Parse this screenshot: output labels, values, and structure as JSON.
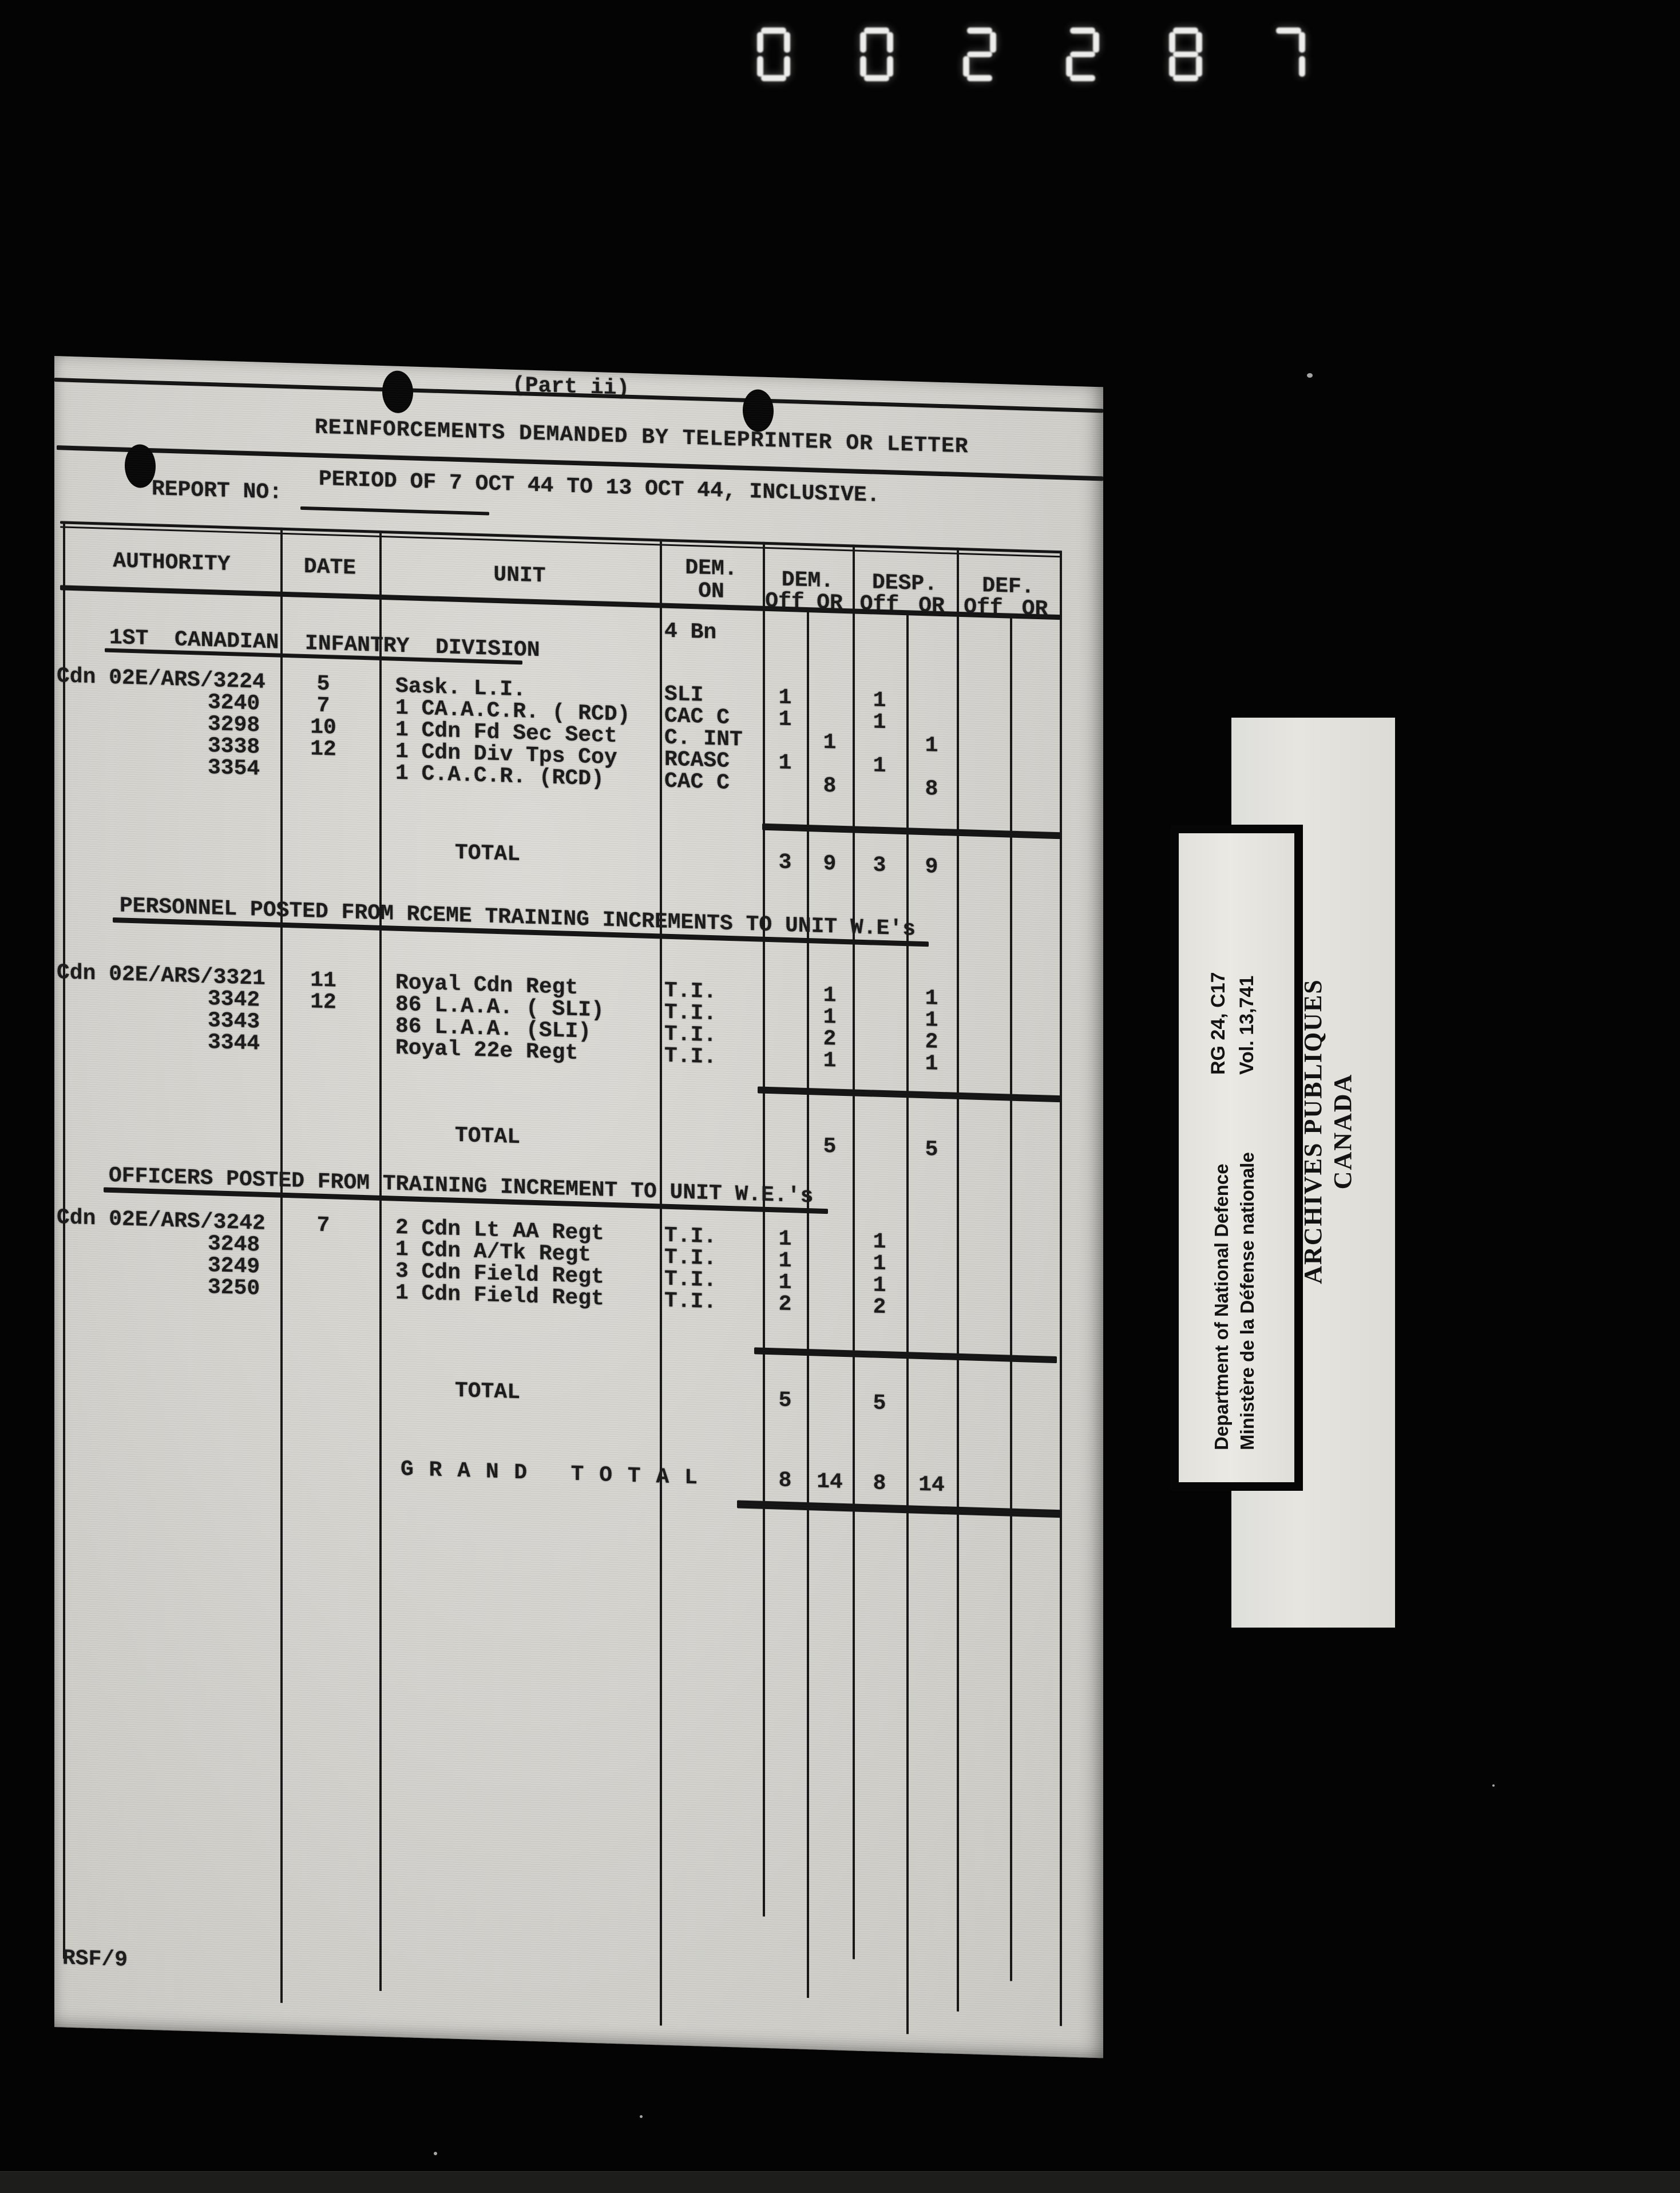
{
  "counter": {
    "digits": "002287"
  },
  "page": {
    "part_label": "(Part ii)",
    "title": "REINFORCEMENTS DEMANDED BY TELEPRINTER OR LETTER",
    "report_no_label": "REPORT NO:",
    "period_line": "PERIOD OF 7 OCT 44 TO 13 OCT 44, INCLUSIVE.",
    "footer_code": "RSF/9"
  },
  "table": {
    "columns": {
      "authority": "AUTHORITY",
      "date": "DATE",
      "unit": "UNIT",
      "dem_on_1": "DEM.",
      "dem_on_2": "ON",
      "dem": "DEM.",
      "desp": "DESP.",
      "def": "DEF.",
      "off": "Off",
      "or": "OR"
    },
    "dem_on_value": "4 Bn",
    "sections": [
      {
        "heading": "1ST  CANADIAN  INFANTRY  DIVISION",
        "rows": [
          {
            "authority": "Cdn 02E/ARS/3224",
            "date": "5",
            "unit": "Sask. L.I.",
            "dem_on": "SLI",
            "dem_off": "1",
            "dem_or": "",
            "desp_off": "1",
            "desp_or": "",
            "def_off": "",
            "def_or": ""
          },
          {
            "authority": "3240",
            "date": "7",
            "unit": "1 CA.A.C.R. ( RCD)",
            "dem_on": "CAC C",
            "dem_off": "1",
            "dem_or": "",
            "desp_off": "1",
            "desp_or": "",
            "def_off": "",
            "def_or": ""
          },
          {
            "authority": "3298",
            "date": "10",
            "unit": "1 Cdn Fd Sec Sect",
            "dem_on": "C. INT",
            "dem_off": "",
            "dem_or": "1",
            "desp_off": "",
            "desp_or": "1",
            "def_off": "",
            "def_or": ""
          },
          {
            "authority": "3338",
            "date": "12",
            "unit": "1 Cdn Div Tps Coy",
            "dem_on": "RCASC",
            "dem_off": "1",
            "dem_or": "",
            "desp_off": "1",
            "desp_or": "",
            "def_off": "",
            "def_or": ""
          },
          {
            "authority": "3354",
            "date": "",
            "unit": "1 C.A.C.R. (RCD)",
            "dem_on": "CAC C",
            "dem_off": "",
            "dem_or": "8",
            "desp_off": "",
            "desp_or": "8",
            "def_off": "",
            "def_or": ""
          }
        ],
        "total": {
          "label": "TOTAL",
          "dem_off": "3",
          "dem_or": "9",
          "desp_off": "3",
          "desp_or": "9"
        }
      },
      {
        "heading": "PERSONNEL POSTED FROM RCEME TRAINING INCREMENTS TO UNIT W.E's",
        "rows": [
          {
            "authority": "Cdn 02E/ARS/3321",
            "date": "11",
            "unit": "Royal Cdn Regt",
            "dem_on": "T.I.",
            "dem_off": "",
            "dem_or": "1",
            "desp_off": "",
            "desp_or": "1",
            "def_off": "",
            "def_or": ""
          },
          {
            "authority": "3342",
            "date": "12",
            "unit": "86 L.A.A. ( SLI)",
            "dem_on": "T.I.",
            "dem_off": "",
            "dem_or": "1",
            "desp_off": "",
            "desp_or": "1",
            "def_off": "",
            "def_or": ""
          },
          {
            "authority": "3343",
            "date": "",
            "unit": "86 L.A.A. (SLI)",
            "dem_on": "T.I.",
            "dem_off": "",
            "dem_or": "2",
            "desp_off": "",
            "desp_or": "2",
            "def_off": "",
            "def_or": ""
          },
          {
            "authority": "3344",
            "date": "",
            "unit": "Royal 22e Regt",
            "dem_on": "T.I.",
            "dem_off": "",
            "dem_or": "1",
            "desp_off": "",
            "desp_or": "1",
            "def_off": "",
            "def_or": ""
          }
        ],
        "total": {
          "label": "TOTAL",
          "dem_off": "",
          "dem_or": "5",
          "desp_off": "",
          "desp_or": "5"
        }
      },
      {
        "heading": "OFFICERS POSTED FROM TRAINING INCREMENT TO UNIT W.E.'s",
        "rows": [
          {
            "authority": "Cdn 02E/ARS/3242",
            "date": "7",
            "unit": "2 Cdn Lt AA Regt",
            "dem_on": "T.I.",
            "dem_off": "1",
            "dem_or": "",
            "desp_off": "1",
            "desp_or": "",
            "def_off": "",
            "def_or": ""
          },
          {
            "authority": "3248",
            "date": "",
            "unit": "1 Cdn A/Tk Regt",
            "dem_on": "T.I.",
            "dem_off": "1",
            "dem_or": "",
            "desp_off": "1",
            "desp_or": "",
            "def_off": "",
            "def_or": ""
          },
          {
            "authority": "3249",
            "date": "",
            "unit": "3 Cdn Field Regt",
            "dem_on": "T.I.",
            "dem_off": "1",
            "dem_or": "",
            "desp_off": "1",
            "desp_or": "",
            "def_off": "",
            "def_or": ""
          },
          {
            "authority": "3250",
            "date": "",
            "unit": "1 Cdn Field Regt",
            "dem_on": "T.I.",
            "dem_off": "2",
            "dem_or": "",
            "desp_off": "2",
            "desp_or": "",
            "def_off": "",
            "def_or": ""
          }
        ],
        "total": {
          "label": "TOTAL",
          "dem_off": "5",
          "dem_or": "",
          "desp_off": "5",
          "desp_or": ""
        }
      }
    ],
    "grand_total": {
      "label": "G R A N D   T O T A L",
      "dem_off": "8",
      "dem_or": "14",
      "desp_off": "8",
      "desp_or": "14"
    }
  },
  "stamps": {
    "department": {
      "line1": "Department of National Defence",
      "line2": "Ministère de la Défense nationale"
    },
    "reference": {
      "line1": "RG 24, C17",
      "line2": "Vol. 13,741"
    },
    "archives": {
      "line1": "PUBLIC ARCHIVES",
      "line2": "ARCHIVES PUBLIQUES",
      "line3": "CANADA"
    }
  },
  "colors": {
    "film_background": "#040404",
    "paper": "#d5d4cf",
    "stamp_paper": "#e5e4df",
    "ink": "#1b1b1b",
    "counter_segments": "#ececea"
  }
}
